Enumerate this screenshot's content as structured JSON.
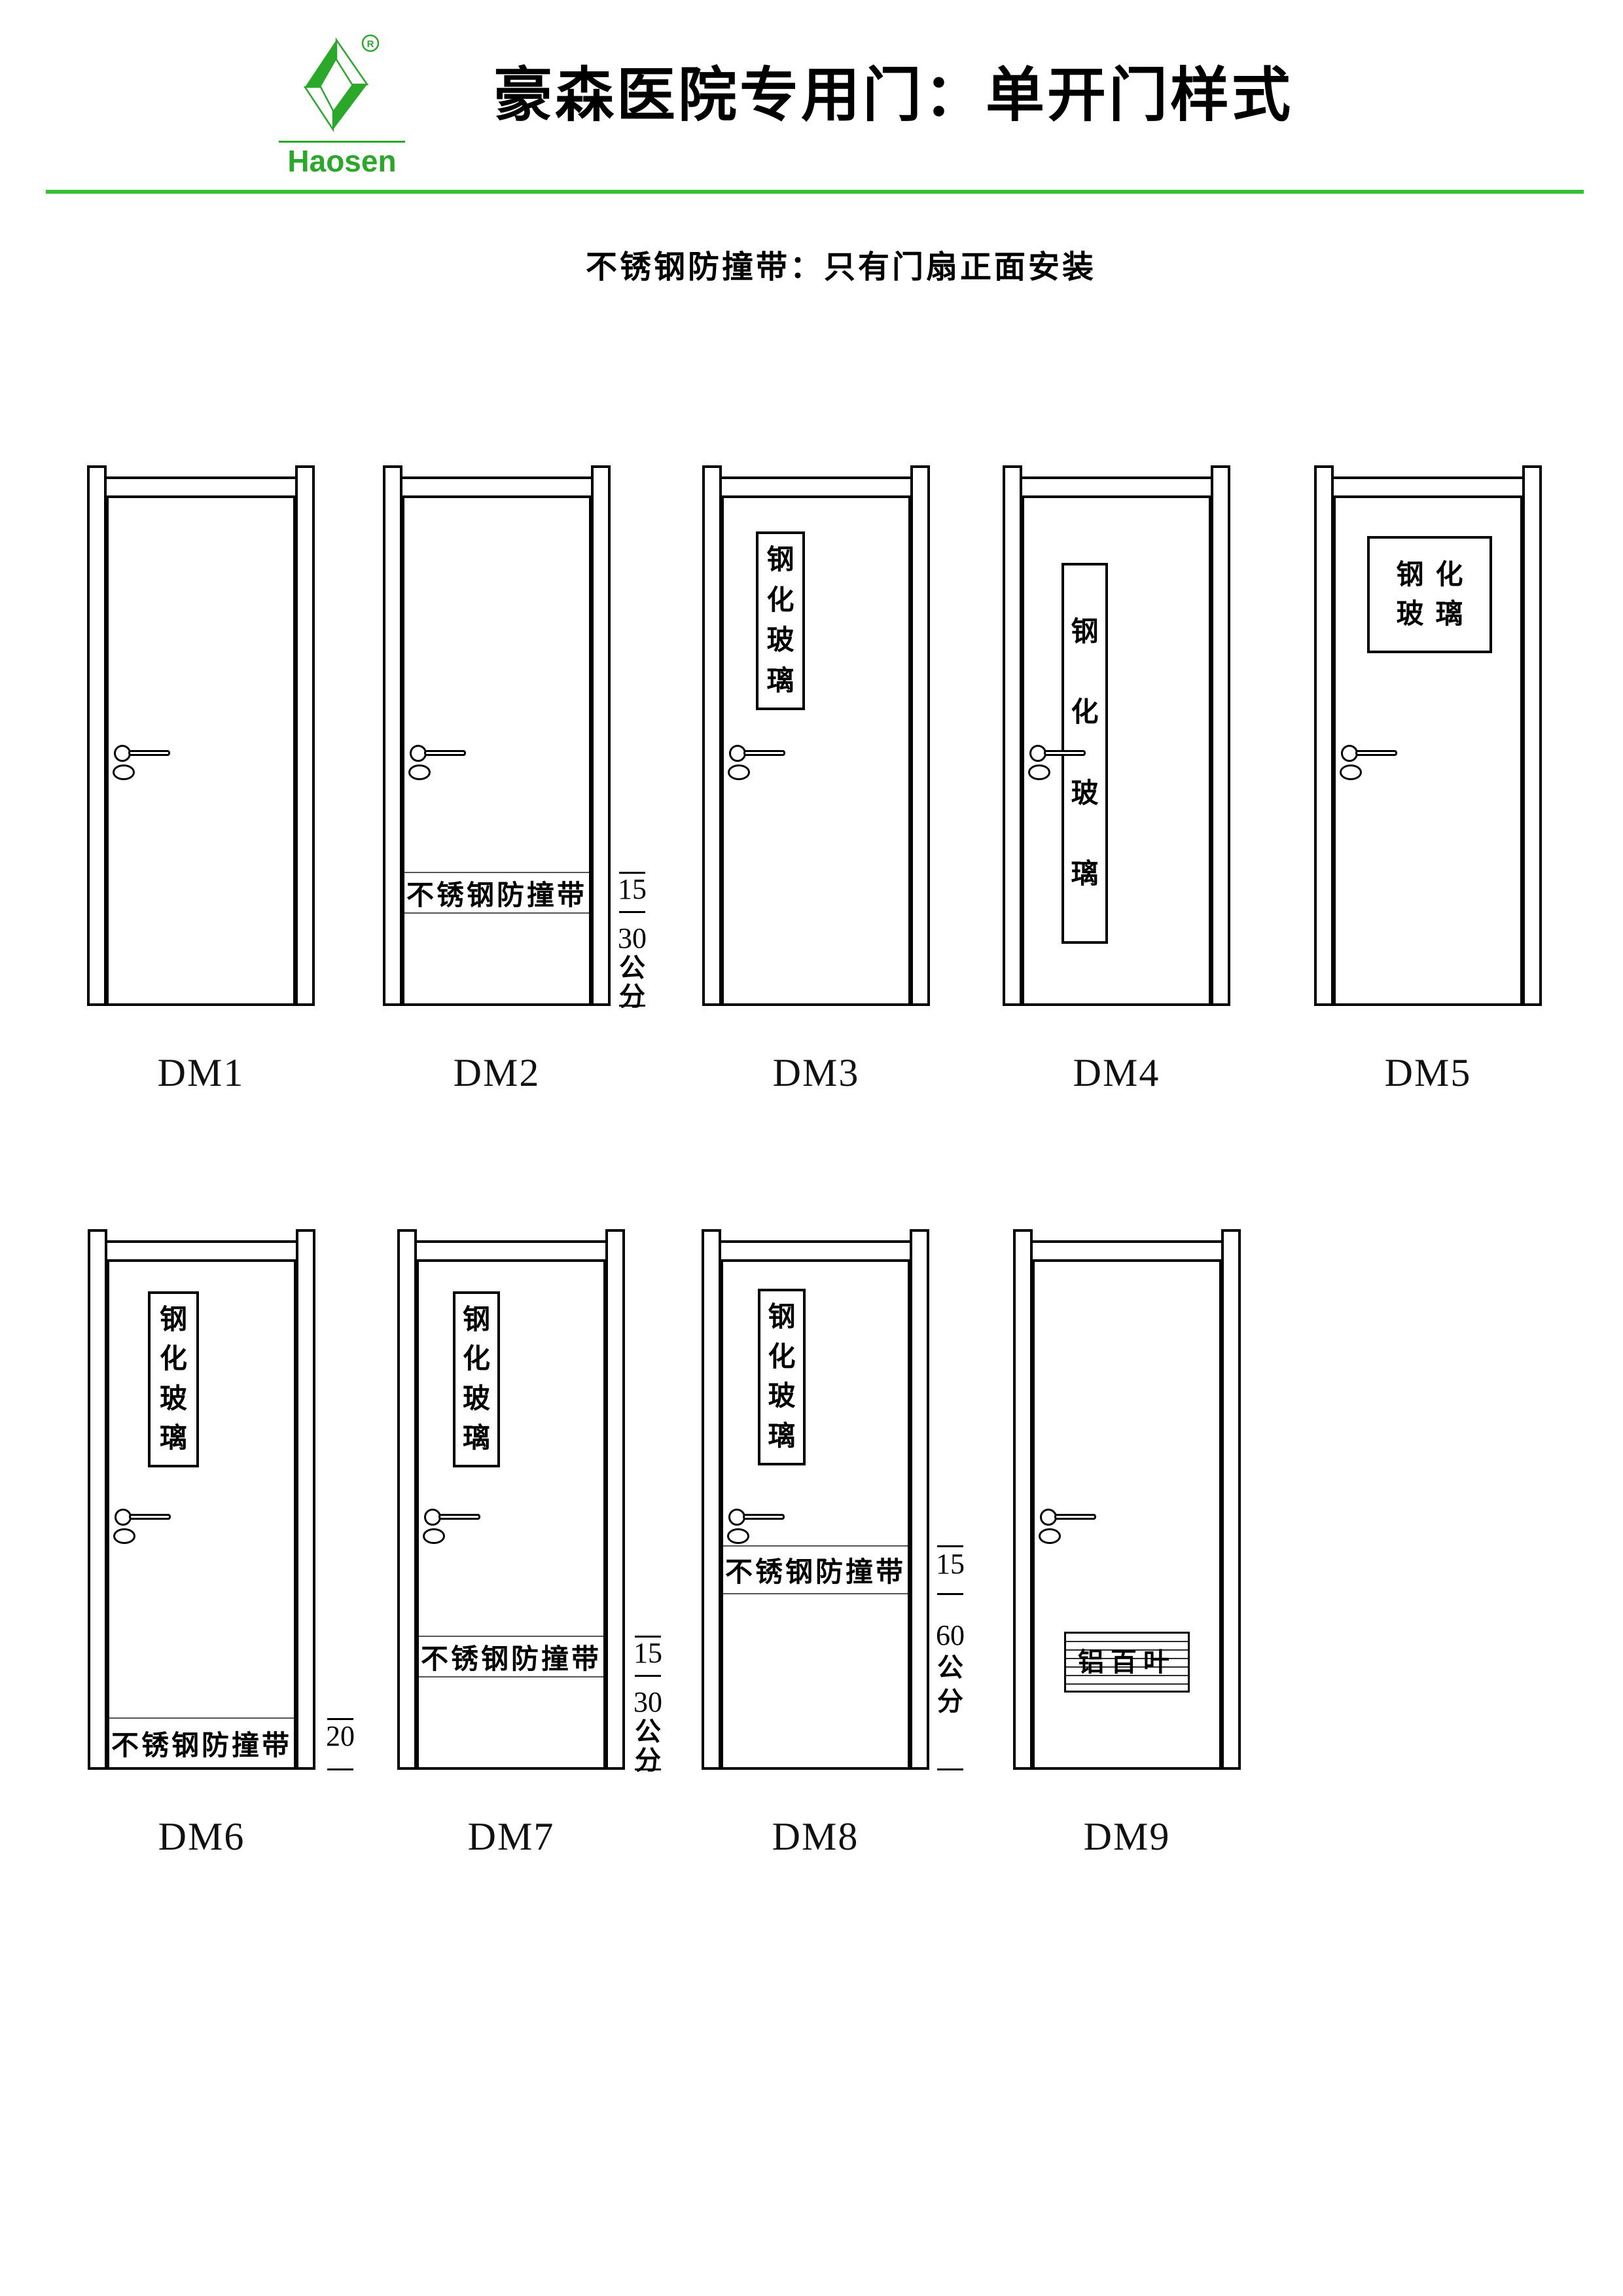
{
  "header": {
    "logo": {
      "brand": "Haosen",
      "registered_mark": "R",
      "color": "#2aa82a"
    },
    "title": "豪森医院专用门：单开门样式",
    "subtitle": "不锈钢防撞带：只有门扇正面安装",
    "divider_color": "#35c135"
  },
  "doors": [
    {
      "id": "DM1",
      "label": "DM1"
    },
    {
      "id": "DM2",
      "label": "DM2",
      "strip_label": "不锈钢防撞带",
      "dimension": {
        "upper": "15",
        "lower": "30",
        "unit_chars": [
          "公",
          "分"
        ]
      }
    },
    {
      "id": "DM3",
      "label": "DM3",
      "glass_chars": [
        "钢",
        "化",
        "玻",
        "璃"
      ]
    },
    {
      "id": "DM4",
      "label": "DM4",
      "glass_chars": [
        "钢",
        "化",
        "玻",
        "璃"
      ]
    },
    {
      "id": "DM5",
      "label": "DM5",
      "glass_rows": [
        "钢化",
        "玻璃"
      ]
    },
    {
      "id": "DM6",
      "label": "DM6",
      "glass_chars": [
        "钢",
        "化",
        "玻",
        "璃"
      ],
      "strip_label": "不锈钢防撞带",
      "dimension": {
        "upper": "20"
      }
    },
    {
      "id": "DM7",
      "label": "DM7",
      "glass_chars": [
        "钢",
        "化",
        "玻",
        "璃"
      ],
      "strip_label": "不锈钢防撞带",
      "dimension": {
        "upper": "15",
        "lower": "30",
        "unit_chars": [
          "公",
          "分"
        ]
      }
    },
    {
      "id": "DM8",
      "label": "DM8",
      "glass_chars": [
        "钢",
        "化",
        "玻",
        "璃"
      ],
      "strip_label": "不锈钢防撞带",
      "dimension": {
        "upper": "15",
        "lower": "60",
        "unit_chars": [
          "公",
          "分"
        ]
      }
    },
    {
      "id": "DM9",
      "label": "DM9",
      "louver_label": "铝百叶"
    }
  ]
}
